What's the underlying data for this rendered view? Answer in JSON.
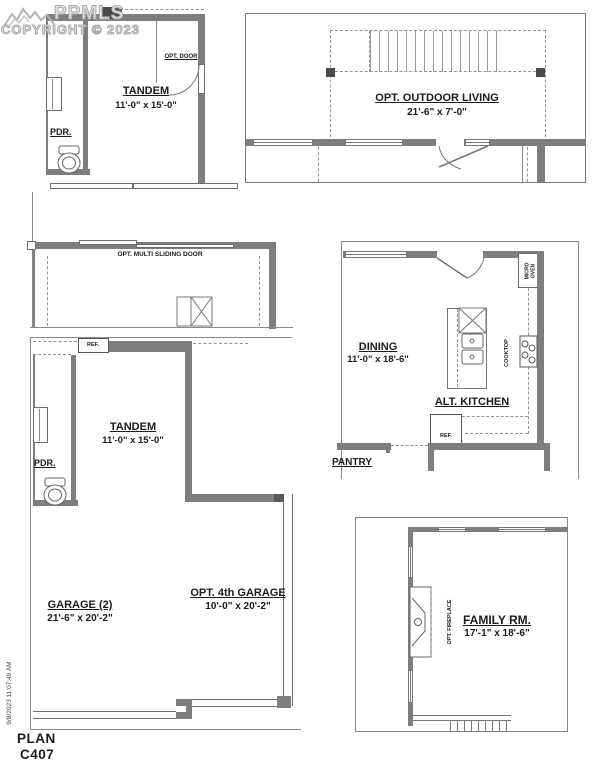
{
  "meta": {
    "watermark_brand": "PPMLS",
    "watermark_copyright": "COPYRIGHT © 2023",
    "print_timestamp": "9/8/2023 11:07:49 AM",
    "plan_word": "PLAN",
    "plan_number": "C407"
  },
  "upper_tandem": {
    "name": "TANDEM",
    "dims": "11'-0\" x 15'-0\"",
    "pdr": "PDR.",
    "opt_door": "OPT. DOOR"
  },
  "outdoor_living": {
    "name": "OPT. OUTDOOR LIVING",
    "dims": "21'-6\" x 7'-0\""
  },
  "multi_sliding": {
    "label": "OPT. MULTI SLIDING DOOR"
  },
  "kitchen": {
    "dining_name": "DINING",
    "dining_dims": "11'-0\" x 18'-6\"",
    "alt_kitchen": "ALT. KITCHEN",
    "ref": "REF.",
    "cooktop": "COOKTOP",
    "micro": "MICRO",
    "oven": "OVEN",
    "pantry": "PANTRY"
  },
  "garage_level": {
    "tandem_name": "TANDEM",
    "tandem_dims": "11'-0\" x 15'-0\"",
    "pdr": "PDR.",
    "ref": "REF.",
    "garage2_name": "GARAGE (2)",
    "garage2_dims": "21'-6\" x 20'-2\"",
    "garage4_name": "OPT. 4th GARAGE",
    "garage4_dims": "10'-0\" x 20'-2\""
  },
  "family_room": {
    "name": "FAMILY RM.",
    "dims": "17'-1\" x 18'-6\"",
    "fireplace": "OPT. FIREPLACE"
  },
  "colors": {
    "wall": "#7e7e7e",
    "wall_dark": "#4a4a4a",
    "watermark": "#ababab",
    "text": "#1b1b1b"
  }
}
